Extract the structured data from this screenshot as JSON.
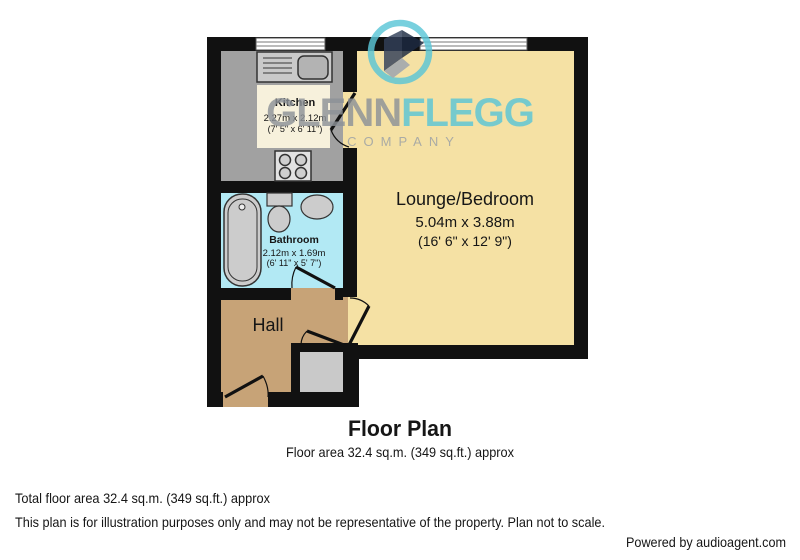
{
  "watermark": {
    "brand_part1": "GLENN",
    "brand_part2": "FLEGG",
    "subtitle": "COMPANY",
    "teal": "#5bc6d7",
    "gray": "#8d9298"
  },
  "rooms": {
    "kitchen": {
      "name": "Kitchen",
      "dims_metric": "2.27m x 2.12m",
      "dims_imperial": "(7' 5\" x 6' 11\")"
    },
    "bathroom": {
      "name": "Bathroom",
      "dims_metric": "2.12m x 1.69m",
      "dims_imperial": "(6' 11\" x 5' 7\")"
    },
    "lounge": {
      "name": "Lounge/Bedroom",
      "dims_metric": "5.04m x 3.88m",
      "dims_imperial": "(16' 6\" x 12' 9\")"
    },
    "hall": {
      "name": "Hall"
    }
  },
  "title": {
    "heading": "Floor Plan",
    "subheading": "Floor area 32.4 sq.m. (349 sq.ft.) approx"
  },
  "footer": {
    "total_area": "Total floor area 32.4 sq.m. (349 sq.ft.) approx",
    "disclaimer": "This plan is for illustration purposes only and may not be representative of the property. Plan not to scale.",
    "credit": "Powered by audioagent.com"
  },
  "colors": {
    "wall": "#111111",
    "kitchen_floor": "#a1a1a1",
    "bathroom_floor": "#b2e9f4",
    "hall_floor": "#c7a377",
    "lounge_floor": "#f5e1a4",
    "label_box": "#f7f1dc",
    "brand_teal": "#5bc6d7",
    "brand_gray": "#8d9298"
  }
}
